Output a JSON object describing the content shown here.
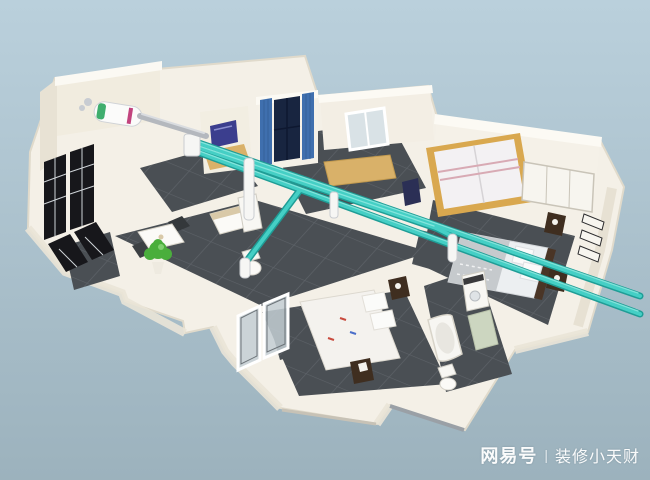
{
  "watermark": {
    "brand": "网易号",
    "separator": "|",
    "author": "装修小天财"
  },
  "colors": {
    "background_top": "#bad0dc",
    "background_bottom": "#9cb2bd",
    "walls": "#f4f0e7",
    "wall_face": "#f1ecdf",
    "floor_tiles": "#4a4f54",
    "duct": "#45cfc5",
    "duct_shadow": "#1f9d96",
    "wood_accent": "#d9a84f",
    "curtain_blue": "#3f6fae",
    "window_frame_black": "#17171b",
    "plant_green": "#4aae3c",
    "tv_screen": "#3b3e8e"
  }
}
